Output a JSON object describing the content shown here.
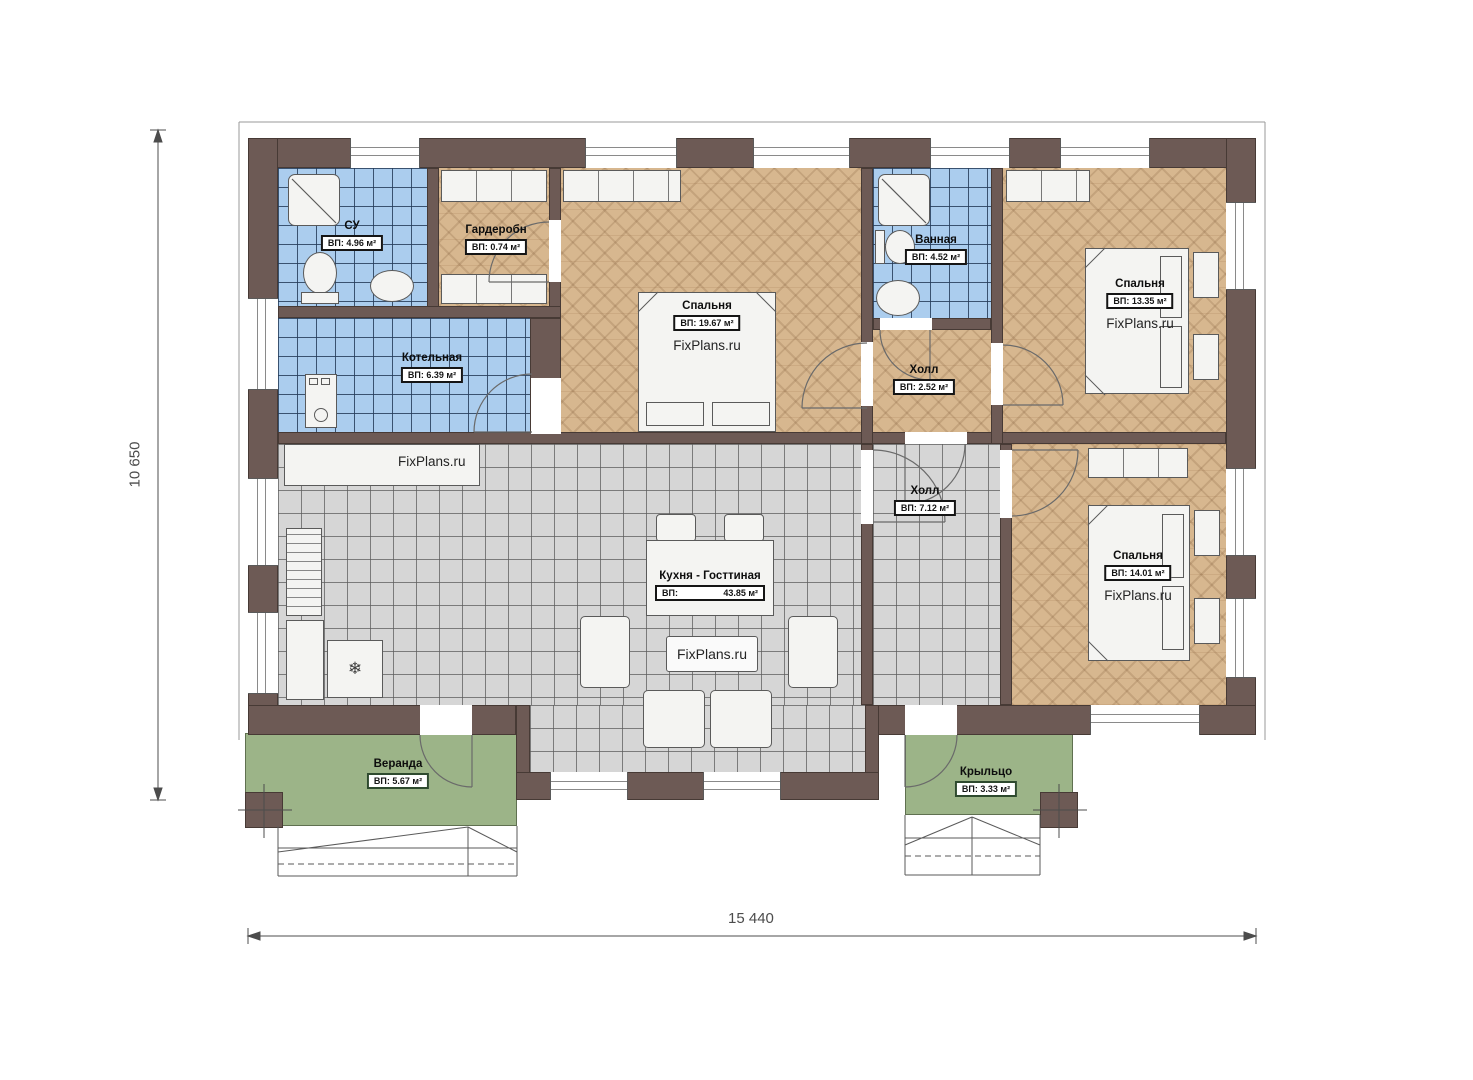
{
  "dimensions": {
    "height": "10 650",
    "width": "15 440"
  },
  "icons": {
    "snowflake": "❄"
  },
  "rooms": {
    "su": {
      "name": "СУ",
      "area": "ВП: 4.96 м²"
    },
    "wardrobe": {
      "name": "Гардеробн",
      "area": "ВП: 0.74 м²"
    },
    "bedroom1": {
      "name": "Спальня",
      "area": "ВП: 19.67 м²",
      "watermark": "FixPlans.ru"
    },
    "bathroom": {
      "name": "Ванная",
      "area": "ВП: 4.52 м²"
    },
    "bedroom2": {
      "name": "Спальня",
      "area": "ВП: 13.35 м²",
      "watermark": "FixPlans.ru"
    },
    "boiler": {
      "name": "Котельная",
      "area": "ВП: 6.39 м²"
    },
    "hall_small": {
      "name": "Холл",
      "area": "ВП: 2.52 м²"
    },
    "kitchen": {
      "name": "Кухня - Госттиная",
      "area_prefix": "ВП:",
      "area_value": "43.85 м²",
      "watermark": "FixPlans.ru",
      "watermark_counter": "FixPlans.ru"
    },
    "hall": {
      "name": "Холл",
      "area": "ВП: 7.12 м²"
    },
    "bedroom3": {
      "name": "Спальня",
      "area": "ВП: 14.01 м²",
      "watermark": "FixPlans.ru"
    },
    "veranda": {
      "name": "Веранда",
      "area": "ВП: 5.67 м²"
    },
    "porch": {
      "name": "Крыльцо",
      "area": "ВП: 3.33 м²"
    }
  },
  "colors": {
    "wall": "#6d5a55",
    "tile_blue": "#abcdee",
    "tile_gray": "#d6d6d6",
    "wood": "#d7b78f",
    "green": "#9cb488"
  }
}
